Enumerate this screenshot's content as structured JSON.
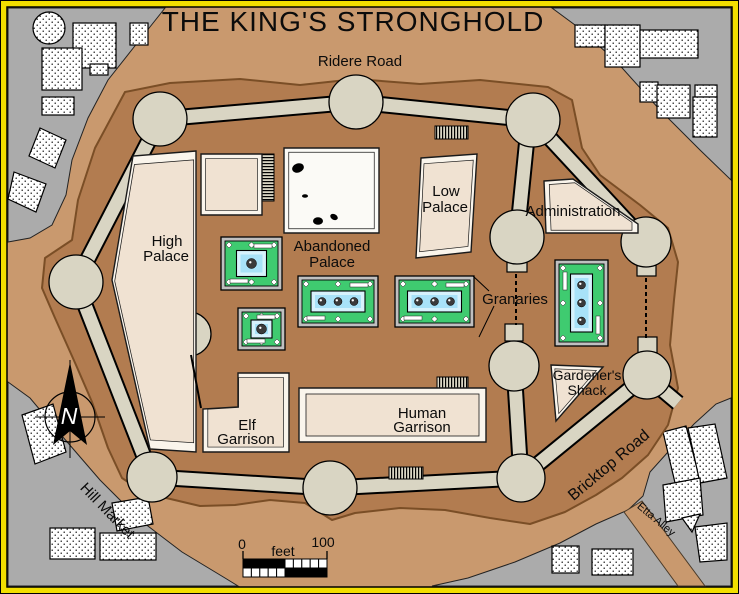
{
  "title": "THE KING'S STRONGHOLD",
  "roads": {
    "ridere": "Ridere Road",
    "bricktop": "Bricktop Road",
    "etta": "Etta Alley",
    "hill_market": "Hill Market"
  },
  "buildings": {
    "high_palace": {
      "label": [
        "High",
        "Palace"
      ]
    },
    "abandoned_palace": {
      "label": [
        "Abandoned",
        "Palace"
      ]
    },
    "low_palace": {
      "label": [
        "Low",
        "Palace"
      ]
    },
    "administration": {
      "label": [
        "Administration"
      ]
    },
    "granaries": {
      "label": [
        "Granaries"
      ]
    },
    "gardeners_shack": {
      "label": [
        "Gardener's",
        "Shack"
      ]
    },
    "elf_garrison": {
      "label": [
        "Elf",
        "Garrison"
      ]
    },
    "human_garrison": {
      "label": [
        "Human",
        "Garrison"
      ]
    }
  },
  "scale_bar": {
    "start": "0",
    "unit": "feet",
    "end": "100"
  },
  "compass": {
    "north": "N"
  },
  "colors": {
    "frame_yellow": "#F2DE00",
    "ground_tan": "#C9996E",
    "mound_brown": "#B27C50",
    "mound_outline": "#7A4E26",
    "wall_gray": "#D9D5C3",
    "city_gray": "#ABABAB",
    "building_cream": "#F0E2D2",
    "building_bevel": "#FAF5EC",
    "abandoned_white": "#FBFAF6",
    "garden_green": "#3FCB70",
    "pool_blue": "#A8E2F8",
    "pool_blue_light": "#D6F2FC",
    "granary_frame_gray": "#C0C0C0",
    "ink": "#0b0b0b"
  }
}
